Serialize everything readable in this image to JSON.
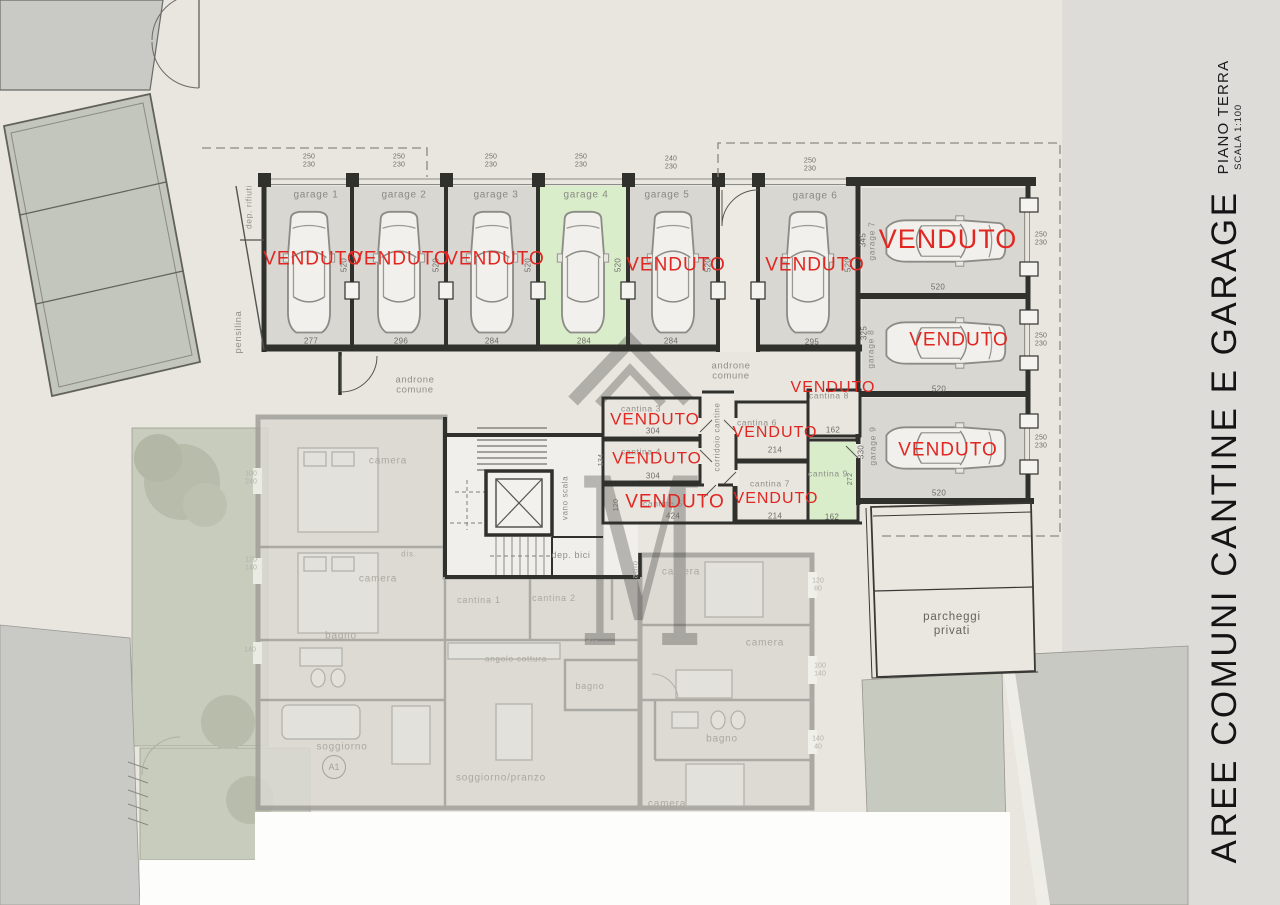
{
  "document": {
    "title_vertical": "AREE COMUNI CANTINE E GARAGE",
    "floor": "PIANO TERRA",
    "scale": "SCALA 1:100"
  },
  "colors": {
    "sold_red": "#e22621",
    "available_green": "#d9edca",
    "paper_beige": "#e9e6df",
    "zone_gray": "#dedcd8",
    "neighbor_gray": "#c3c6bc",
    "garden_green": "#c8ccbd"
  },
  "watermark": {
    "letter": "M"
  },
  "garages": [
    {
      "name": "garage 1",
      "width": "277",
      "depth": "520",
      "door": "250\n230",
      "sold": "VENDUTO"
    },
    {
      "name": "garage 2",
      "width": "296",
      "depth": "520",
      "door": "250\n230",
      "sold": "VENDUTO"
    },
    {
      "name": "garage 3",
      "width": "284",
      "depth": "520",
      "door": "250\n230",
      "sold": "VENDUTO"
    },
    {
      "name": "garage 4",
      "width": "284",
      "depth": "520",
      "door": "250\n230",
      "sold": ""
    },
    {
      "name": "garage 5",
      "width": "284",
      "depth": "520",
      "door": "240\n230",
      "sold": "VENDUTO"
    },
    {
      "name": "garage 6",
      "width": "295",
      "depth": "520",
      "door": "250\n230",
      "sold": "VENDUTO"
    },
    {
      "name": "garage 7",
      "width": "520",
      "depth": "345",
      "door": "250\n230",
      "sold": "VENDUTO"
    },
    {
      "name": "garage 8",
      "width": "520",
      "depth": "325",
      "door": "250\n230",
      "sold": "VENDUTO"
    },
    {
      "name": "garage 9",
      "width": "520",
      "depth": "330",
      "door": "250\n230",
      "sold": "VENDUTO"
    }
  ],
  "cantine": [
    {
      "name": "cantina 1",
      "sold": ""
    },
    {
      "name": "cantina 2",
      "sold": ""
    },
    {
      "name": "cantina 3",
      "width": "304",
      "sold": "VENDUTO"
    },
    {
      "name": "cantina 4",
      "width": "304",
      "depth": "134",
      "sold": "VENDUTO"
    },
    {
      "name": "cantina 5",
      "width": "424",
      "depth": "120",
      "sold": "VENDUTO"
    },
    {
      "name": "cantina 6",
      "width": "214",
      "sold": "VENDUTO"
    },
    {
      "name": "cantina 7",
      "width": "214",
      "sold": "VENDUTO"
    },
    {
      "name": "cantina 8",
      "width": "162",
      "sold": "VENDUTO"
    },
    {
      "name": "cantina 9",
      "width": "162",
      "depth": "272",
      "sold": ""
    }
  ],
  "common_areas": {
    "androne": "androne\ncomune",
    "corridoio_cantine": "corridoio cantine",
    "vano_scala": "vano scala",
    "dep_bici": "dep. bici",
    "dep_rifiuti": "dep. rifiuti",
    "pensilina": "pensilina",
    "parcheggi": "parcheggi\nprivati"
  },
  "apartment": {
    "unit_label": "A1",
    "rooms": [
      "camera",
      "dis.",
      "camera",
      "bagno",
      "soggiorno",
      "soggiorno/pranzo",
      "angolo cottura",
      "dis.",
      "bagno",
      "camera",
      "cab. armadio",
      "camera",
      "bagno",
      "camera"
    ],
    "dims": [
      "100\n240",
      "120\n140",
      "140",
      "120\n60",
      "100\n140",
      "140\n40"
    ]
  }
}
